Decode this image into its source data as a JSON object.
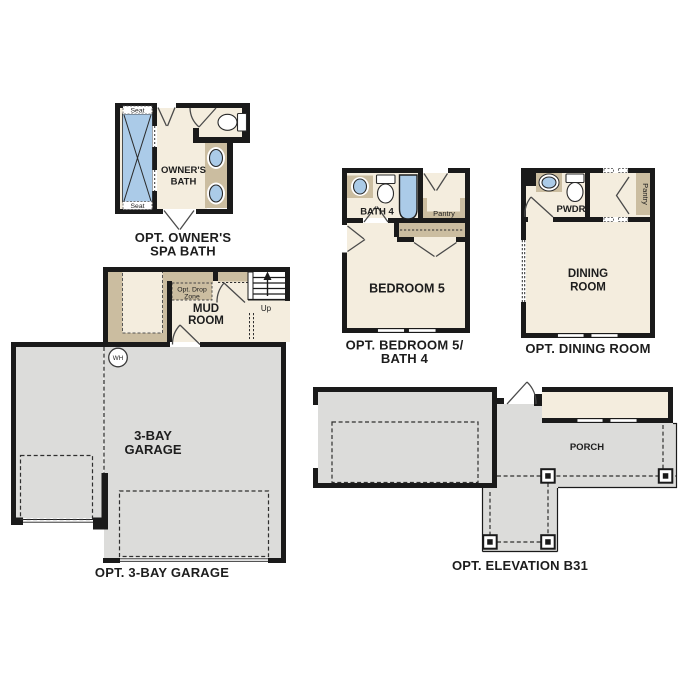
{
  "colors": {
    "wall": "#1a1a1a",
    "room_fill": "#f4edde",
    "cabinet_tan": "#cbbda0",
    "garage_gray": "#dcdcda",
    "fixture_blue": "#abcbe8",
    "background": "#ffffff"
  },
  "spa_bath": {
    "caption1": "OPT. OWNER'S",
    "caption2": "SPA BATH",
    "room1": "OWNER'S",
    "room2": "BATH",
    "seat_top": "Seat",
    "seat_bottom": "Seat"
  },
  "bedroom5": {
    "caption1": "OPT. BEDROOM 5/",
    "caption2": "BATH 4",
    "bath": "BATH 4",
    "pantry": "Pantry",
    "room": "BEDROOM 5"
  },
  "dining": {
    "caption": "OPT. DINING ROOM",
    "powder": "PWDR",
    "pantry": "Pantry",
    "room1": "DINING",
    "room2": "ROOM"
  },
  "garage": {
    "caption": "OPT. 3-BAY GARAGE",
    "room1": "3-BAY",
    "room2": "GARAGE",
    "mud1": "MUD",
    "mud2": "ROOM",
    "drop1": "Opt. Drop",
    "drop2": "Zone",
    "up": "Up",
    "wh": "WH"
  },
  "elevation": {
    "caption": "OPT. ELEVATION B31",
    "porch": "PORCH"
  }
}
